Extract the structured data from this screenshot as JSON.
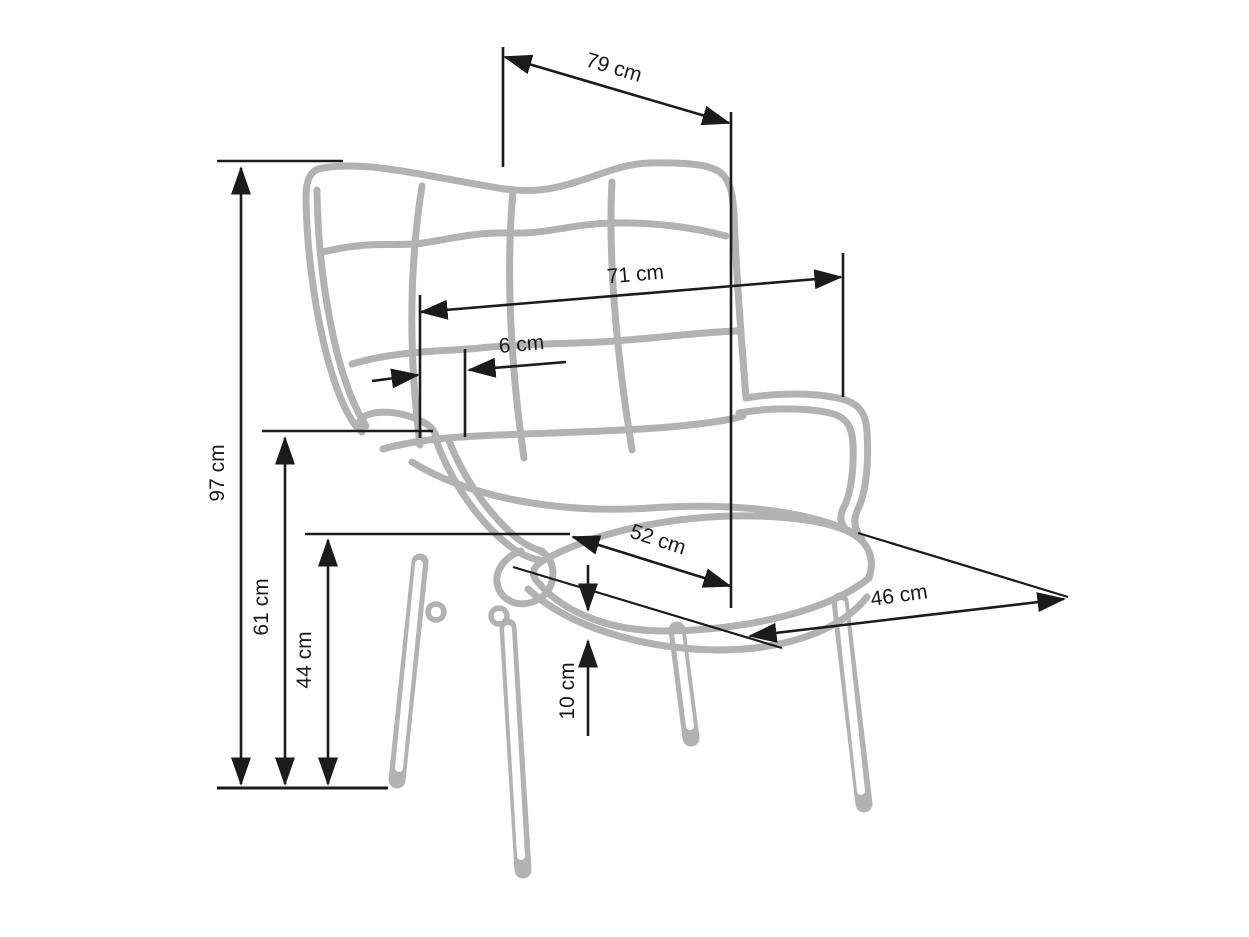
{
  "page": {
    "type": "product-dimension-diagram",
    "subject": "wingback armchair line drawing with dimension callouts",
    "background_color": "#ffffff",
    "chair_color": "#b2b2b2",
    "dimension_line_color": "#1b1b1b"
  },
  "dimensions": {
    "overall_depth_top": {
      "label": "79 cm",
      "value": 79,
      "unit": "cm"
    },
    "overall_height": {
      "label": "97 cm",
      "value": 97,
      "unit": "cm"
    },
    "back_width": {
      "label": "71 cm",
      "value": 71,
      "unit": "cm"
    },
    "wing_offset": {
      "label": "6 cm",
      "value": 6,
      "unit": "cm"
    },
    "arm_height": {
      "label": "61 cm",
      "value": 61,
      "unit": "cm"
    },
    "seat_height": {
      "label": "44 cm",
      "value": 44,
      "unit": "cm"
    },
    "seat_width": {
      "label": "52 cm",
      "value": 52,
      "unit": "cm"
    },
    "seat_depth": {
      "label": "46 cm",
      "value": 46,
      "unit": "cm"
    },
    "cushion_thickness": {
      "label": "10 cm",
      "value": 10,
      "unit": "cm"
    }
  }
}
